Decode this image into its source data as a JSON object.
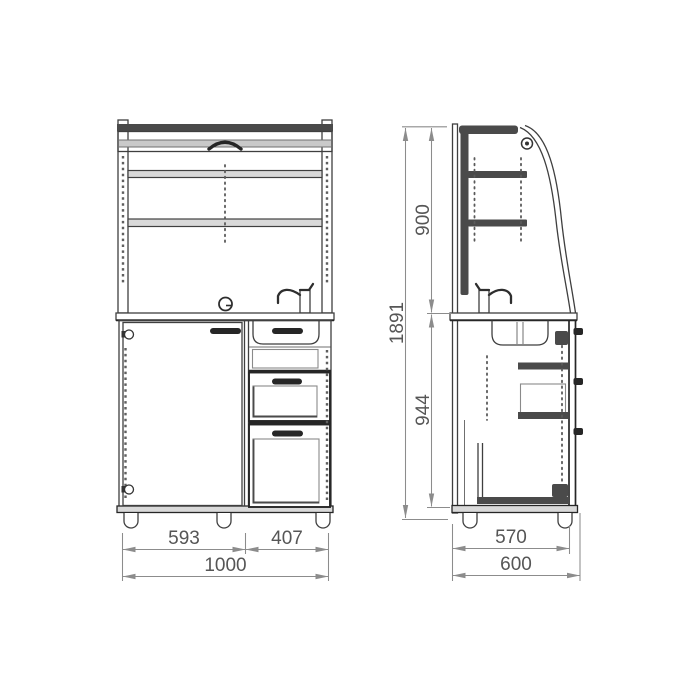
{
  "drawing": {
    "front_view": {
      "dim_door_width": "593",
      "dim_drawers_width": "407",
      "dim_total_width": "1000"
    },
    "side_view": {
      "dim_upper_height": "900",
      "dim_lower_height": "944",
      "dim_total_height": "1891",
      "dim_body_depth": "570",
      "dim_total_depth": "600"
    }
  },
  "colors": {
    "background": "#ffffff",
    "object_line": "#3f3f3f",
    "heavy_line": "#262626",
    "fill_dark": "#4a4a4a",
    "dim_line": "#8c8c8c",
    "dim_text": "#565656"
  }
}
